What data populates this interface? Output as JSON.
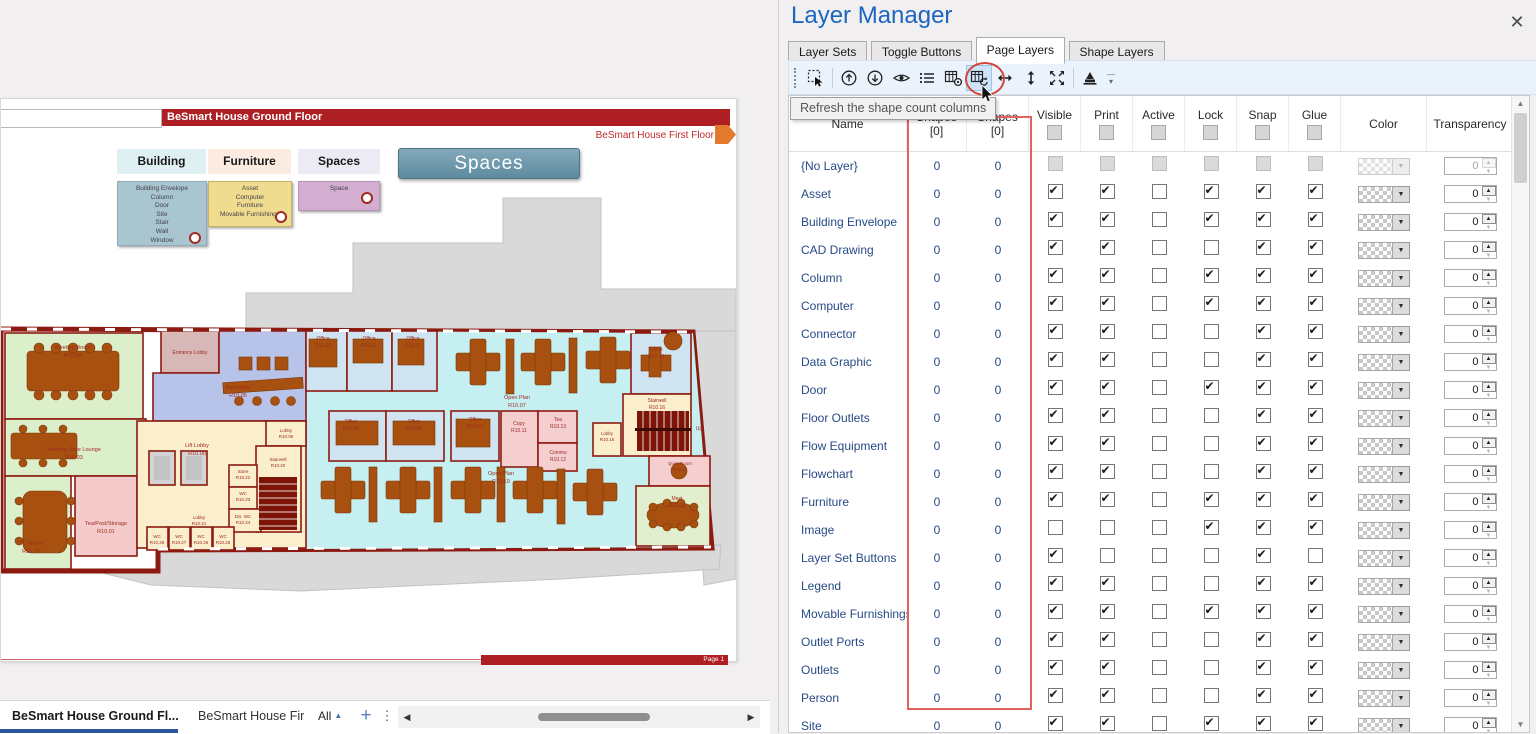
{
  "canvas": {
    "banner": "BeSmart House Ground Floor",
    "floor_link": "BeSmart House First Floor",
    "toggle_buttons": {
      "building": "Building",
      "furniture": "Furniture",
      "spaces": "Spaces"
    },
    "big_button": "Spaces",
    "legend_boxes": {
      "building": [
        "Building Envelope",
        "Column",
        "Door",
        "Site",
        "Stair",
        "Wall",
        "Window"
      ],
      "furniture": [
        "Asset",
        "Computer",
        "Furniture",
        "Movable Furnishings"
      ],
      "spaces": [
        "Space"
      ]
    },
    "page_label": "Page 1",
    "rooms": {
      "meeting_room": {
        "name": "Meeting Room",
        "id": "R10.04"
      },
      "entrance_lobby": {
        "name": "Entrance Lobby",
        "id": ""
      },
      "reception": {
        "name": "Reception",
        "id": "R10.05"
      },
      "meeting_suite_lounge": {
        "name": "Meeting Suite Lounge",
        "id": "R10.03"
      },
      "vc_room": {
        "name": "VC Room",
        "id": "R10.02"
      },
      "tea_post_storage": {
        "name": "Tea/Post/Storage",
        "id": "R10.01"
      },
      "lift_lobby": {
        "name": "Lift Lobby",
        "id": "R10.00"
      },
      "lobby_06": {
        "name": "Lobby",
        "id": "R10.06"
      },
      "stairwell_20": {
        "name": "Stairwell",
        "id": "R10.20"
      },
      "store_22": {
        "name": "Store",
        "id": "R10.22"
      },
      "wc_23": {
        "name": "WC",
        "id": "R10.23"
      },
      "dis_wc_24": {
        "name": "Dis. WC",
        "id": "R10.24"
      },
      "lobby_21": {
        "name": "Lobby",
        "id": "R10.21"
      },
      "wc_28": {
        "name": "WC",
        "id": "R10.28"
      },
      "wc_27": {
        "name": "WC",
        "id": "R10.27"
      },
      "wc_26": {
        "name": "WC",
        "id": "R10.26"
      },
      "wc_25": {
        "name": "WC",
        "id": "R10.25"
      },
      "office_30": {
        "name": "Office",
        "id": "R10.30"
      },
      "office_31": {
        "name": "Office",
        "id": "R10.31"
      },
      "office_32": {
        "name": "Office",
        "id": "R10.32"
      },
      "open_plan_07": {
        "name": "Open Plan",
        "id": "R10.07"
      },
      "office_14": {
        "name": "Office",
        "id": "R10.14"
      },
      "office_08": {
        "name": "Office",
        "id": "R10.08"
      },
      "office_09": {
        "name": "Office",
        "id": "R10.09"
      },
      "office_10": {
        "name": "Office",
        "id": "R10.10"
      },
      "copy_11": {
        "name": "Copy",
        "id": "R10.11"
      },
      "tea_13": {
        "name": "Tea",
        "id": "R10.13"
      },
      "comms_12": {
        "name": "Comms",
        "id": "R10.12"
      },
      "lobby_15": {
        "name": "Lobby",
        "id": "R10.15"
      },
      "stairwell_16": {
        "name": "Stairwell",
        "id": "R10.16"
      },
      "up_label": {
        "name": "Up",
        "id": ""
      },
      "quiet_17": {
        "name": "Quiet Room",
        "id": "R10.17"
      },
      "meet_18": {
        "name": "Meet",
        "id": "R10.18"
      },
      "open_plan_19": {
        "name": "Open Plan",
        "id": "R10.19"
      }
    }
  },
  "tab_bar": {
    "active_tab": "BeSmart House Ground Fl...",
    "second_tab": "BeSmart House Fir",
    "pages_filter": "All",
    "add_label": "+",
    "more_label": "⋮",
    "left_arrow": "◀",
    "right_arrow": "▶"
  },
  "panel": {
    "title": "Layer Manager",
    "close_label": "✕",
    "tabs": [
      {
        "label": "Layer Sets",
        "active": false
      },
      {
        "label": "Toggle Buttons",
        "active": false
      },
      {
        "label": "Page Layers",
        "active": true
      },
      {
        "label": "Shape Layers",
        "active": false
      }
    ],
    "toolbar": {
      "tooltip": "Refresh the shape count columns",
      "icons": [
        "drag-handle",
        "marquee-select",
        "circle-up-arrow",
        "circle-down-arrow",
        "eye",
        "list",
        "table-settings",
        "table-refresh",
        "fit-width",
        "fit-height",
        "expand",
        "stamp",
        "overflow-chevron"
      ]
    },
    "table": {
      "name_header": "Name",
      "shapes_header": "Shapes",
      "shapes_count": "[0]",
      "check_columns": [
        "Visible",
        "Print",
        "Active",
        "Lock",
        "Snap",
        "Glue"
      ],
      "color_header": "Color",
      "transparency_header": "Transparency",
      "rows": [
        {
          "name": "{No Layer}",
          "s1": "0",
          "s2": "0",
          "checks": [
            0,
            0,
            0,
            0,
            0,
            0
          ],
          "disabled": true,
          "transparency": "0"
        },
        {
          "name": "Asset",
          "s1": "0",
          "s2": "0",
          "checks": [
            1,
            1,
            0,
            1,
            1,
            1
          ],
          "disabled": false,
          "transparency": "0"
        },
        {
          "name": "Building Envelope",
          "s1": "0",
          "s2": "0",
          "checks": [
            1,
            1,
            0,
            1,
            1,
            1
          ],
          "disabled": false,
          "transparency": "0"
        },
        {
          "name": "CAD Drawing",
          "s1": "0",
          "s2": "0",
          "checks": [
            1,
            1,
            0,
            0,
            1,
            1
          ],
          "disabled": false,
          "transparency": "0"
        },
        {
          "name": "Column",
          "s1": "0",
          "s2": "0",
          "checks": [
            1,
            1,
            0,
            1,
            1,
            1
          ],
          "disabled": false,
          "transparency": "0"
        },
        {
          "name": "Computer",
          "s1": "0",
          "s2": "0",
          "checks": [
            1,
            1,
            0,
            1,
            1,
            1
          ],
          "disabled": false,
          "transparency": "0"
        },
        {
          "name": "Connector",
          "s1": "0",
          "s2": "0",
          "checks": [
            1,
            1,
            0,
            0,
            1,
            1
          ],
          "disabled": false,
          "transparency": "0"
        },
        {
          "name": "Data Graphic",
          "s1": "0",
          "s2": "0",
          "checks": [
            1,
            1,
            0,
            0,
            1,
            1
          ],
          "disabled": false,
          "transparency": "0"
        },
        {
          "name": "Door",
          "s1": "0",
          "s2": "0",
          "checks": [
            1,
            1,
            0,
            1,
            1,
            1
          ],
          "disabled": false,
          "transparency": "0"
        },
        {
          "name": "Floor Outlets",
          "s1": "0",
          "s2": "0",
          "checks": [
            1,
            1,
            0,
            0,
            1,
            1
          ],
          "disabled": false,
          "transparency": "0"
        },
        {
          "name": "Flow Equipment",
          "s1": "0",
          "s2": "0",
          "checks": [
            1,
            1,
            0,
            0,
            1,
            1
          ],
          "disabled": false,
          "transparency": "0"
        },
        {
          "name": "Flowchart",
          "s1": "0",
          "s2": "0",
          "checks": [
            1,
            1,
            0,
            0,
            1,
            1
          ],
          "disabled": false,
          "transparency": "0"
        },
        {
          "name": "Furniture",
          "s1": "0",
          "s2": "0",
          "checks": [
            1,
            1,
            0,
            1,
            1,
            1
          ],
          "disabled": false,
          "transparency": "0"
        },
        {
          "name": "Image",
          "s1": "0",
          "s2": "0",
          "checks": [
            0,
            0,
            0,
            1,
            1,
            1
          ],
          "disabled": false,
          "transparency": "0"
        },
        {
          "name": "Layer Set Buttons",
          "s1": "0",
          "s2": "0",
          "checks": [
            1,
            0,
            0,
            0,
            1,
            0
          ],
          "disabled": false,
          "transparency": "0"
        },
        {
          "name": "Legend",
          "s1": "0",
          "s2": "0",
          "checks": [
            1,
            1,
            0,
            0,
            1,
            1
          ],
          "disabled": false,
          "transparency": "0"
        },
        {
          "name": "Movable Furnishings",
          "s1": "0",
          "s2": "0",
          "checks": [
            1,
            1,
            0,
            1,
            1,
            1
          ],
          "disabled": false,
          "transparency": "0"
        },
        {
          "name": "Outlet Ports",
          "s1": "0",
          "s2": "0",
          "checks": [
            1,
            1,
            0,
            0,
            1,
            1
          ],
          "disabled": false,
          "transparency": "0"
        },
        {
          "name": "Outlets",
          "s1": "0",
          "s2": "0",
          "checks": [
            1,
            1,
            0,
            0,
            1,
            1
          ],
          "disabled": false,
          "transparency": "0"
        },
        {
          "name": "Person",
          "s1": "0",
          "s2": "0",
          "checks": [
            1,
            1,
            0,
            0,
            1,
            1
          ],
          "disabled": false,
          "transparency": "0"
        },
        {
          "name": "Site",
          "s1": "0",
          "s2": "0",
          "checks": [
            1,
            1,
            0,
            1,
            1,
            1
          ],
          "disabled": false,
          "transparency": "0"
        }
      ]
    },
    "colors": {
      "accent_blue": "#1d66c0",
      "highlight_red": "#e3635c",
      "row_text_blue": "#264a86",
      "wall_red": "#8c1a10"
    }
  }
}
